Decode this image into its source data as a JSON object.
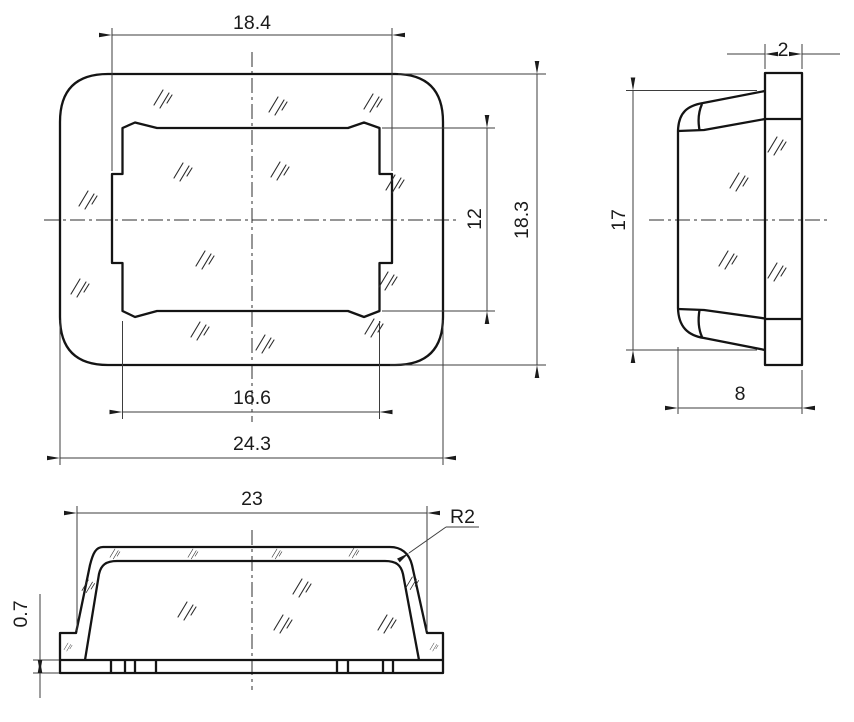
{
  "drawing": {
    "title": "cap-three-view-dimensioned-drawing",
    "front_view": {
      "top_width": "18.4",
      "overall_height": "18.3",
      "inner_height": "12",
      "inner_width": "16.6",
      "overall_width": "24.3"
    },
    "side_view": {
      "flange_thickness": "2",
      "height": "17",
      "depth": "8"
    },
    "bottom_view": {
      "top_width": "23",
      "corner_radius": "R2",
      "base_thickness": "0.7"
    },
    "colors": {
      "contour": "#141414",
      "thin_line": "#3d3d3d",
      "background": "#ffffff"
    }
  }
}
